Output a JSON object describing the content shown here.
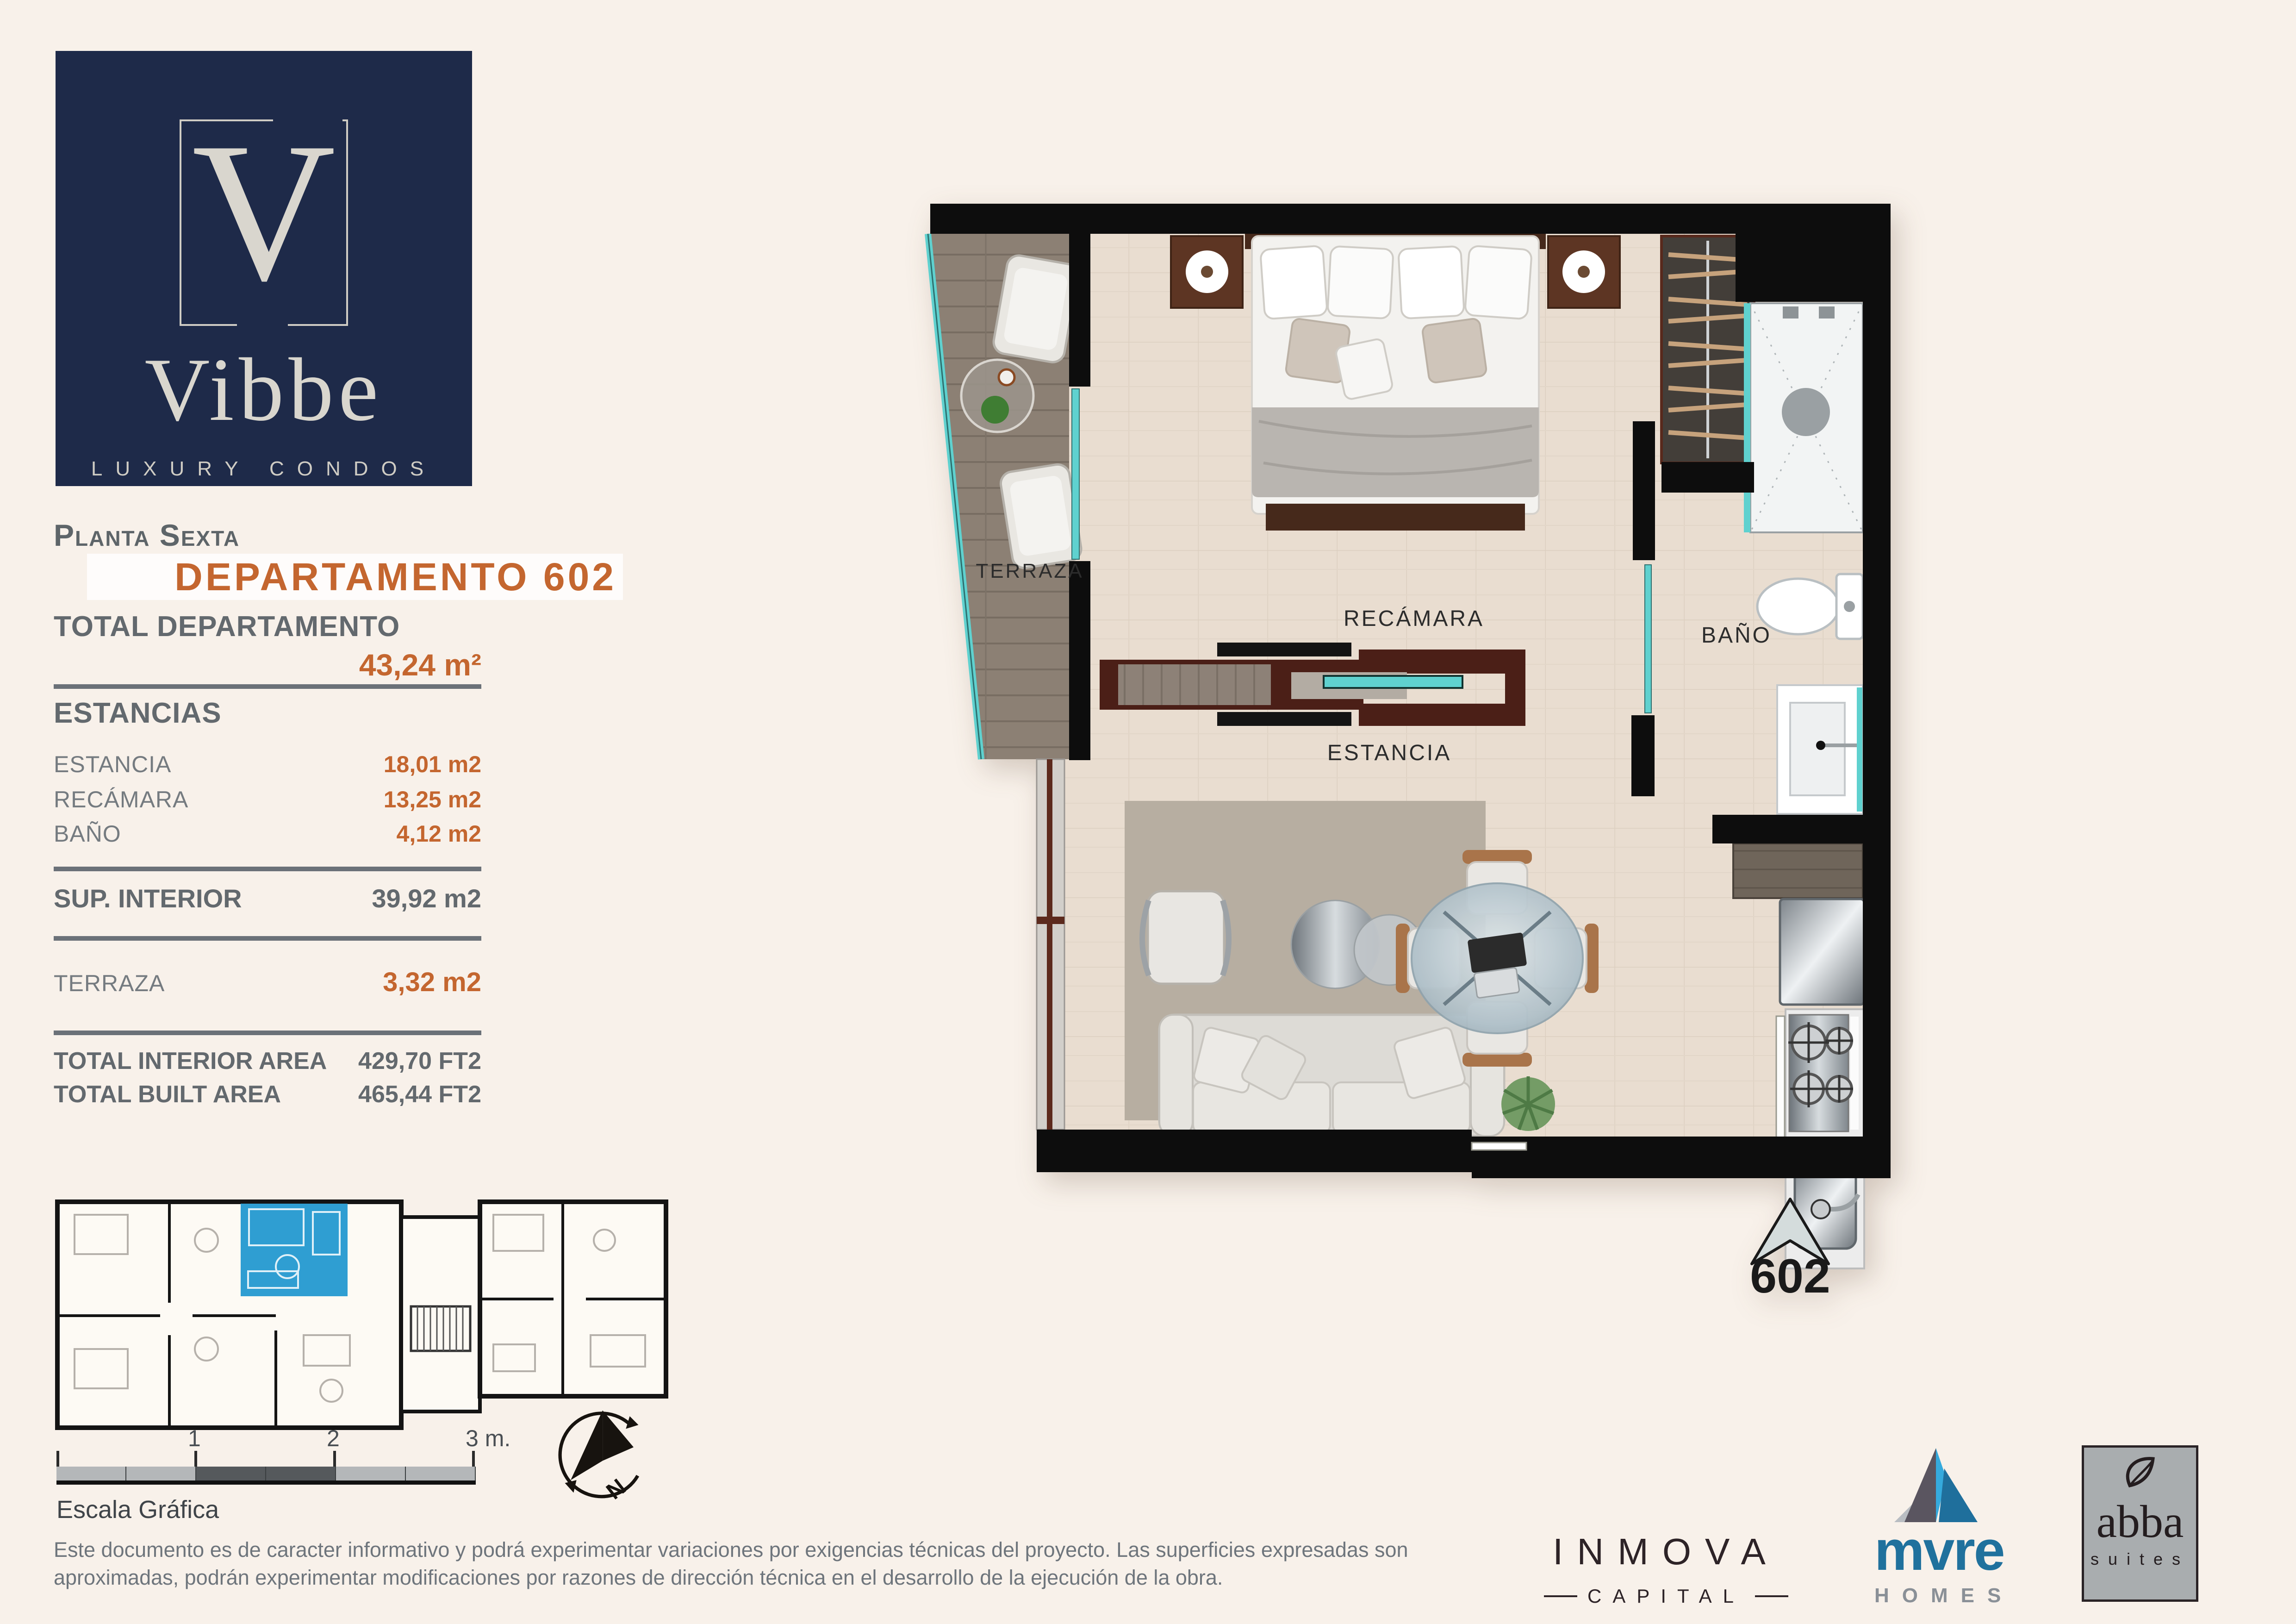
{
  "brand": {
    "letter": "V",
    "name": "Vibbe",
    "tagline": "LUXURY CONDOS"
  },
  "header": {
    "floor": "Planta Sexta",
    "unit": "DEPARTAMENTO 602"
  },
  "areas": {
    "total_label": "TOTAL DEPARTAMENTO",
    "total_value": "43,24 m²",
    "section_label": "ESTANCIAS",
    "rows": [
      {
        "label": "ESTANCIA",
        "value": "18,01 m2"
      },
      {
        "label": "RECÁMARA",
        "value": "13,25 m2"
      },
      {
        "label": "BAÑO",
        "value": "4,12 m2"
      }
    ],
    "sup": {
      "label": "SUP. INTERIOR",
      "value": "39,92 m2"
    },
    "terraza": {
      "label": "TERRAZA",
      "value": "3,32 m2"
    },
    "totals": [
      {
        "label": "TOTAL INTERIOR AREA",
        "value": "429,70 FT2"
      },
      {
        "label": "TOTAL BUILT AREA",
        "value": "465,44 FT2"
      }
    ]
  },
  "plan": {
    "labels": {
      "terraza": "TERRAZA",
      "recamara": "RECÁMARA",
      "bano": "BAÑO",
      "estancia": "ESTANCIA"
    },
    "marker": "602"
  },
  "compass": {
    "north": "N"
  },
  "scalebar": {
    "ticks": [
      "1",
      "2",
      "3 m."
    ],
    "caption": "Escala Gráfica"
  },
  "disclaimer": {
    "text": "Este documento es de caracter informativo y podrá experimentar variaciones por exigencias técnicas del proyecto. Las superficies expresadas son aproximadas, podrán experimentar modificaciones por razones de dirección técnica en el desarrollo de la ejecución de la obra."
  },
  "partners": {
    "inmova": {
      "name": "INMOVA",
      "sub": "CAPITAL"
    },
    "mvre": {
      "name": "mvre",
      "sub": "HOMES"
    },
    "abba": {
      "name": "abba",
      "sub": "suites"
    }
  },
  "colors": {
    "background": "#f8f1ea",
    "navy": "#1e2a49",
    "accent_orange": "#c4662f",
    "text_gray": "#63696e",
    "teal_glass": "#5fd1cf",
    "highlight_unit_blue": "#2f9ed2",
    "mvre_blue": "#20719d",
    "wall_black": "#0d0d0d"
  }
}
